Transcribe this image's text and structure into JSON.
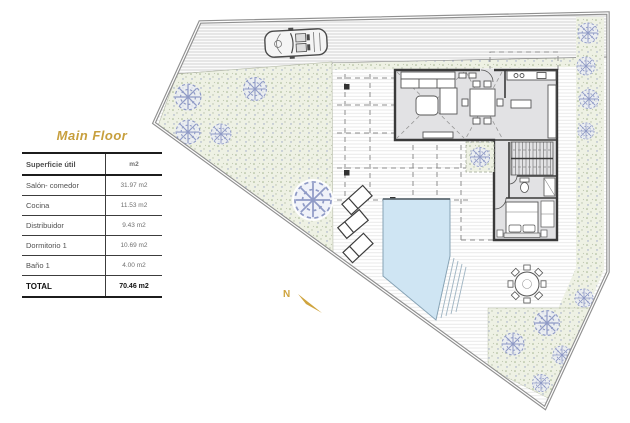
{
  "page": {
    "background": "#ffffff"
  },
  "legend_table": {
    "title": "Main Floor",
    "header": {
      "label": "Superficie útil",
      "unit": "m2"
    },
    "rows": [
      {
        "label": "Salón- comedor",
        "value": "31.97 m2"
      },
      {
        "label": "Cocina",
        "value": "11.53 m2"
      },
      {
        "label": "Distribuidor",
        "value": "9.43 m2"
      },
      {
        "label": "Dormitorio 1",
        "value": "10.69 m2"
      },
      {
        "label": "Baño 1",
        "value": "4.00 m2"
      }
    ],
    "total": {
      "label": "TOTAL",
      "value": "70.46 m2"
    }
  },
  "plan": {
    "north_label": "N",
    "colors": {
      "accent_gold": "#c79f3d",
      "boundary_gray": "#8f8f8f",
      "wall_dark": "#3a3a3a",
      "pool_blue": "#cfe5f3",
      "grass_green": "#edf0e3",
      "tree_blue": "#8f9ac6",
      "room_floor": "#e2e2e4",
      "hatch_gray": "#d9d9d9"
    }
  }
}
